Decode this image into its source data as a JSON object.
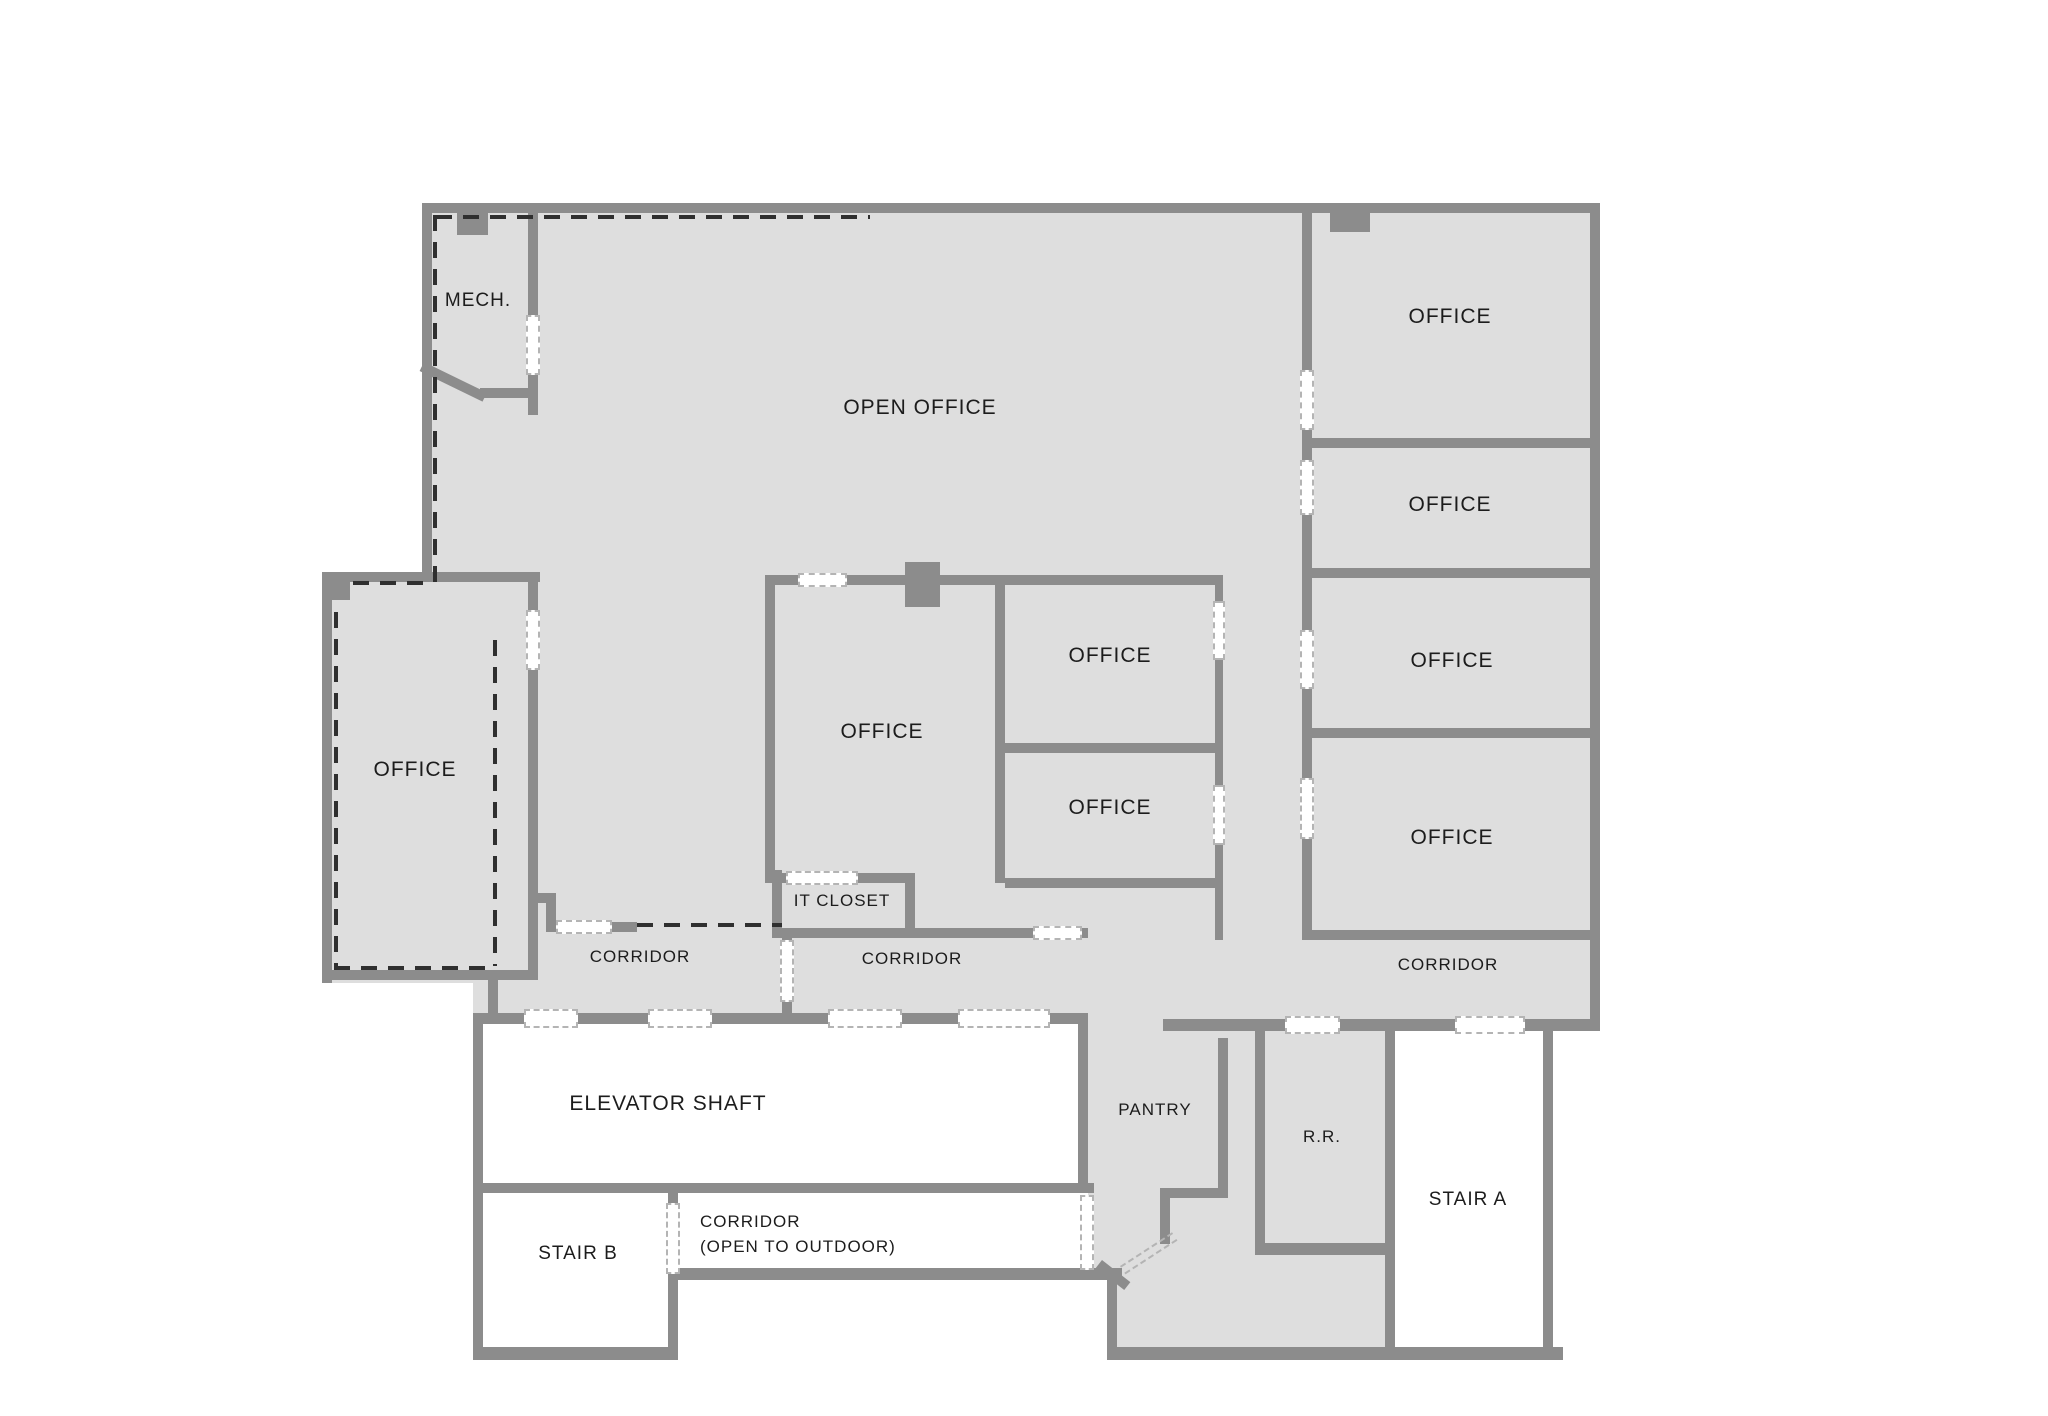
{
  "plan_title": "Office floor plan",
  "colors": {
    "floor": "#dedede",
    "wall": "#8c8c8c",
    "door_dash": "#b4b4b4",
    "demising_dash": "#2f2f2f",
    "label_text": "#1c1c1c",
    "service_room_floor": "#ffffff"
  },
  "rooms": {
    "mech": {
      "label": "MECH."
    },
    "open_office": {
      "label": "OPEN OFFICE"
    },
    "office_left": {
      "label": "OFFICE"
    },
    "office_center": {
      "label": "OFFICE"
    },
    "office_small_top": {
      "label": "OFFICE"
    },
    "office_small_bottom": {
      "label": "OFFICE"
    },
    "office_right_1": {
      "label": "OFFICE"
    },
    "office_right_2": {
      "label": "OFFICE"
    },
    "office_right_3": {
      "label": "OFFICE"
    },
    "office_right_4": {
      "label": "OFFICE"
    },
    "it_closet": {
      "label": "IT CLOSET"
    },
    "corridor_west": {
      "label": "CORRIDOR"
    },
    "corridor_center": {
      "label": "CORRIDOR"
    },
    "corridor_east": {
      "label": "CORRIDOR"
    },
    "elevator_shaft": {
      "label": "ELEVATOR SHAFT"
    },
    "stair_b": {
      "label": "STAIR B"
    },
    "corridor_outdoor": {
      "label_line1": "CORRIDOR",
      "label_line2": "(OPEN TO OUTDOOR)"
    },
    "pantry": {
      "label": "PANTRY"
    },
    "restroom": {
      "label": "R.R."
    },
    "stair_a": {
      "label": "STAIR A"
    }
  }
}
